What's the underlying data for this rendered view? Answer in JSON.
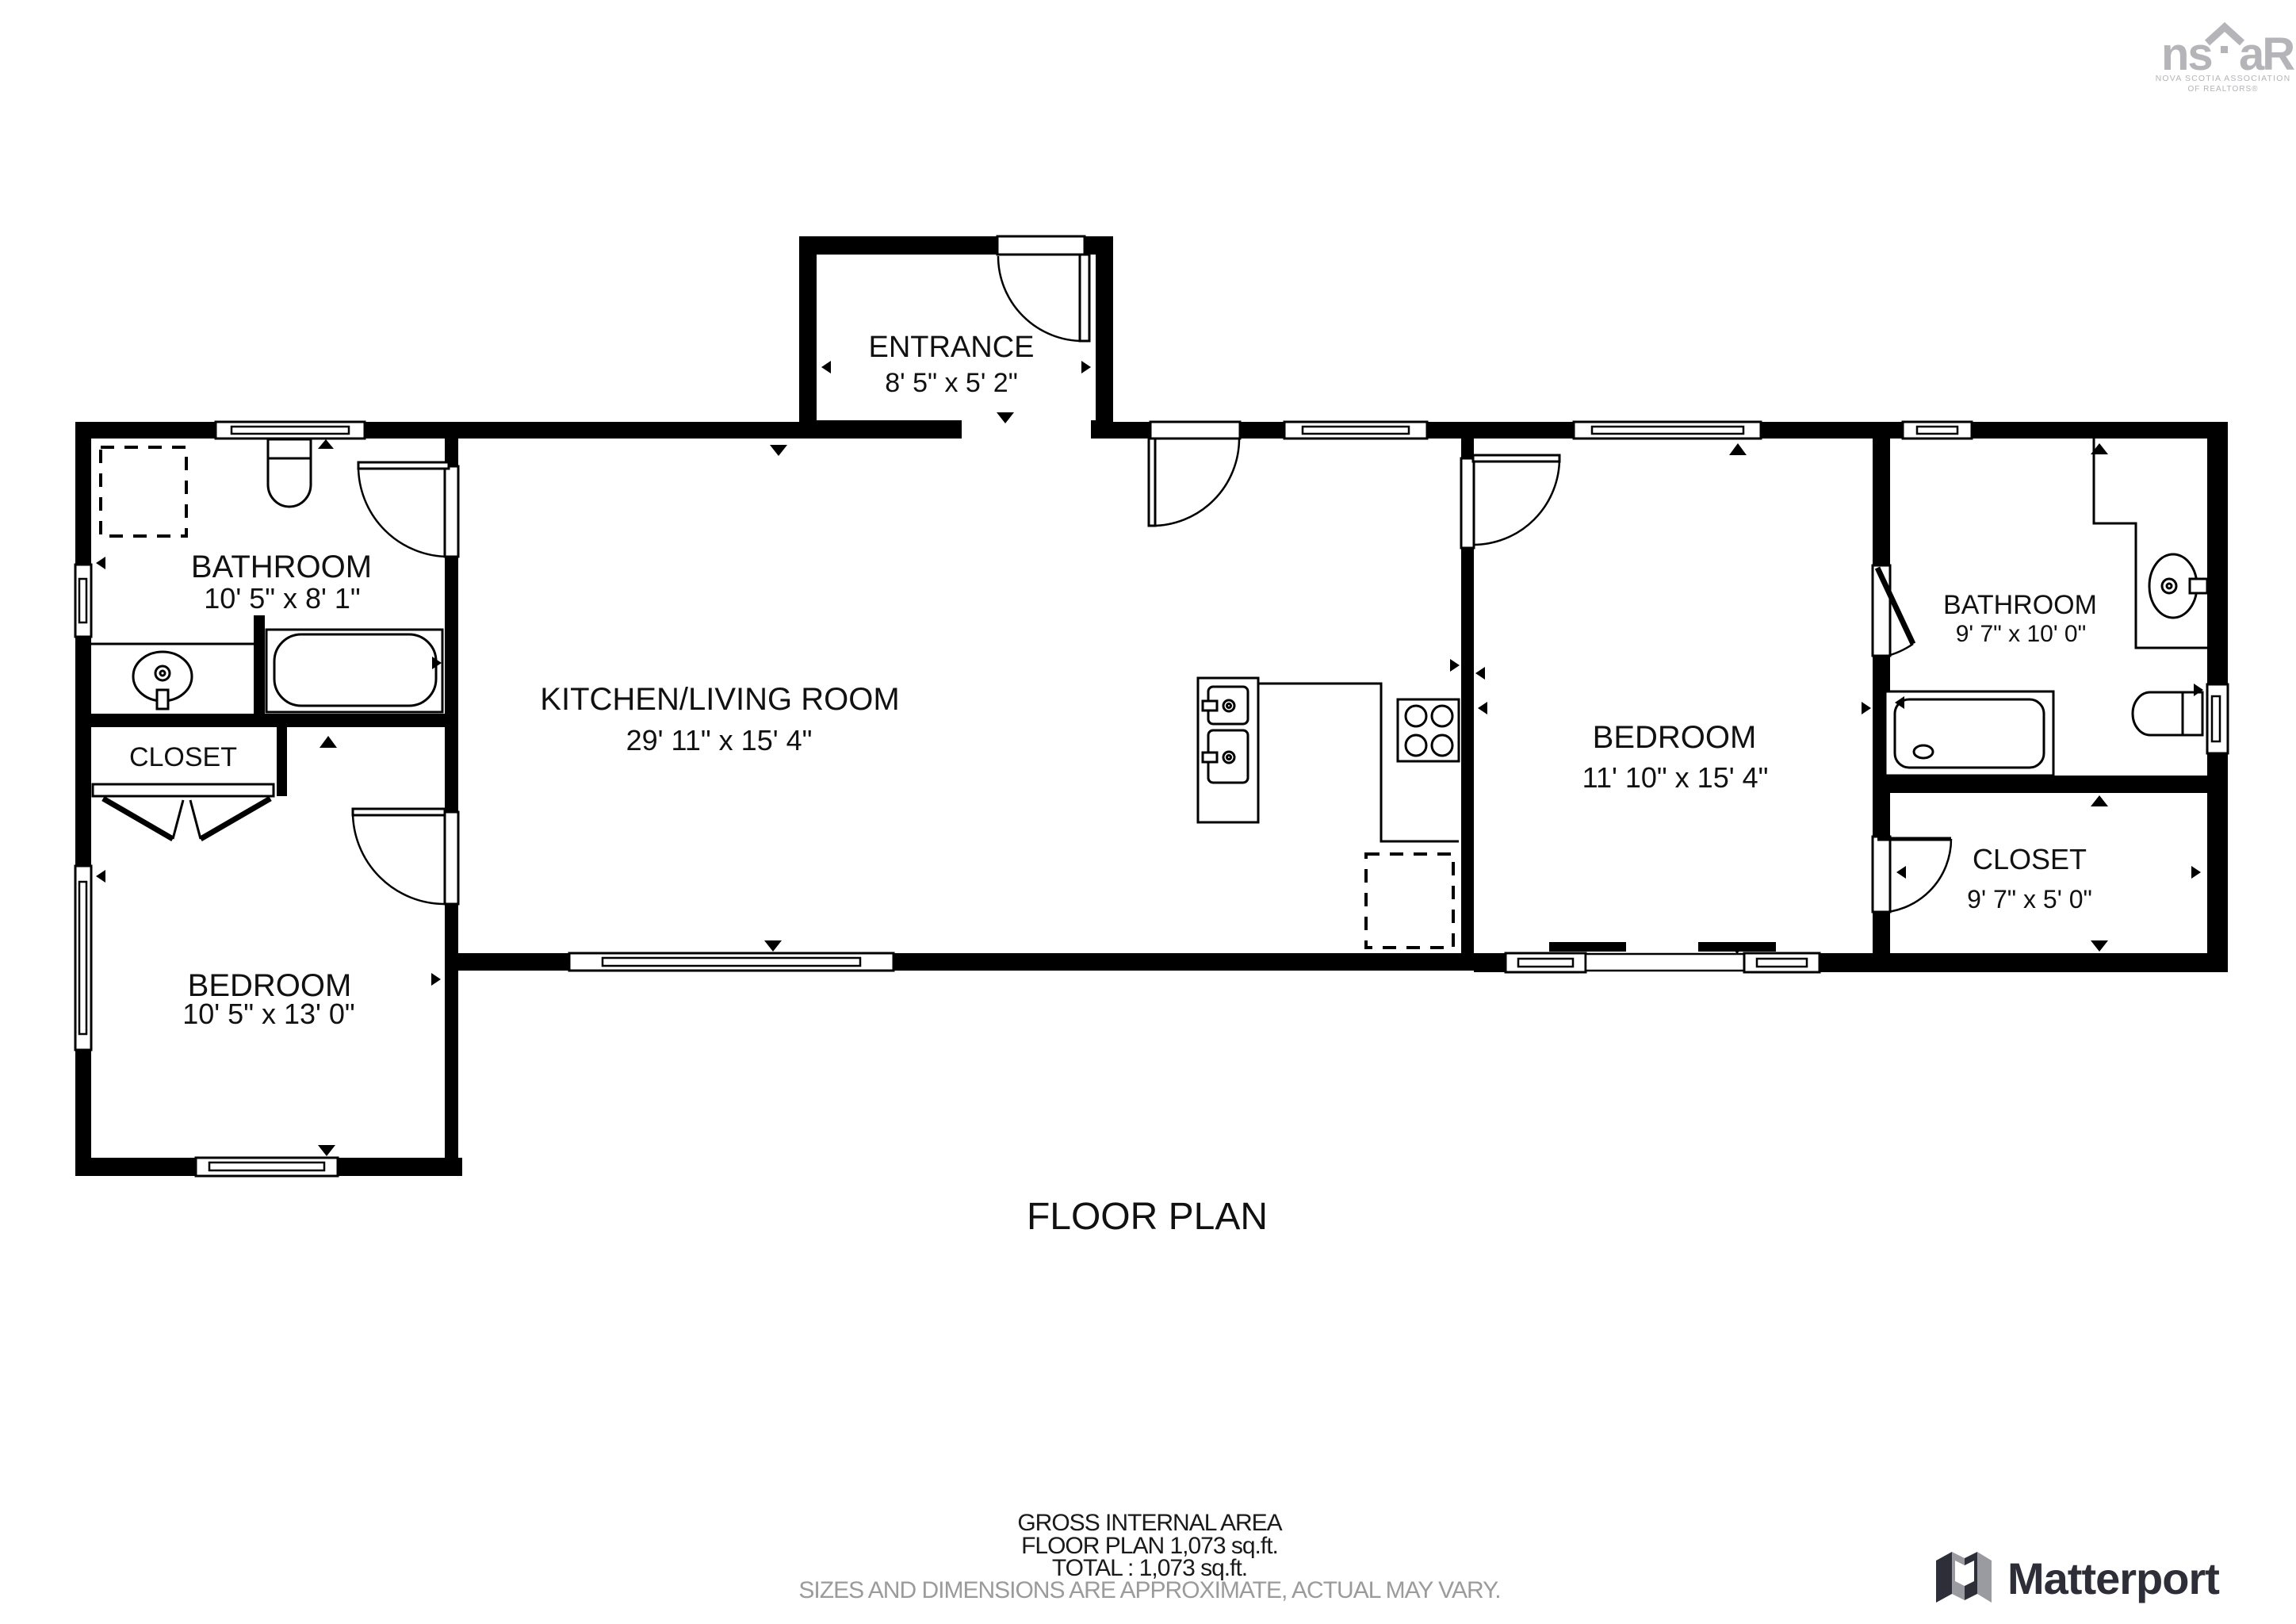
{
  "title": "FLOOR PLAN",
  "rooms": [
    {
      "name": "ENTRANCE",
      "dims": "8' 5\" x 5' 2\""
    },
    {
      "name": "BATHROOM",
      "dims": "10' 5\" x 8' 1\""
    },
    {
      "name": "KITCHEN/LIVING ROOM",
      "dims": "29' 11\" x 15' 4\""
    },
    {
      "name": "CLOSET",
      "dims": ""
    },
    {
      "name": "BEDROOM",
      "dims": "10' 5\" x 13' 0\""
    },
    {
      "name": "BEDROOM",
      "dims": "11' 10\" x 15' 4\""
    },
    {
      "name": "BATHROOM",
      "dims": "9' 7\" x 10' 0\""
    },
    {
      "name": "CLOSET",
      "dims": "9' 7\" x 5' 0\""
    }
  ],
  "footer": {
    "area_label": "GROSS INTERNAL AREA",
    "area_line": "FLOOR PLAN 1,073 sq.ft.",
    "total_line": "TOTAL :  1,073 sq.ft.",
    "disclaimer": "SIZES AND DIMENSIONS ARE APPROXIMATE, ACTUAL MAY VARY."
  },
  "logo_nsar": {
    "ns": "ns",
    "ar": "aR",
    "subtitle1": "NOVA SCOTIA ASSOCIATION",
    "subtitle2": "OF REALTORS®"
  },
  "matterport_label": "Matterport",
  "colors": {
    "wall": "#000000",
    "disclaimer_gray": "#9b9b9b",
    "nsar_gray": "#b4b4b9",
    "matterport_dark": "#2e2e38"
  }
}
